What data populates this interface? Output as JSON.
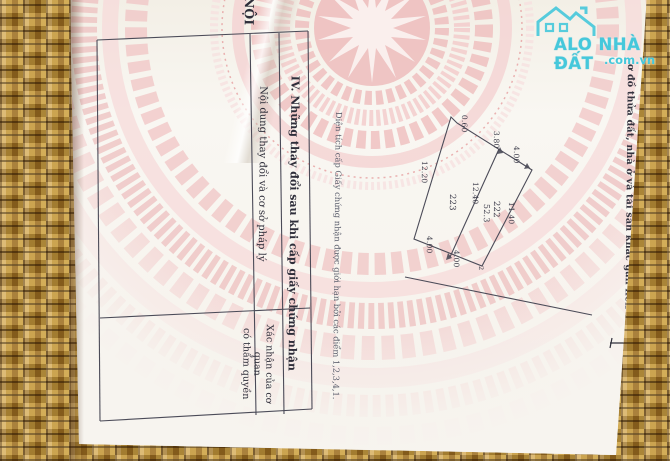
{
  "colors": {
    "accent_cyan": "#45c8db",
    "paper": "#f7f4ef",
    "emblem_pink": "#f0c2c2",
    "mat_tan": "#a3742b",
    "line": "#4b4b58"
  },
  "watermark": {
    "brand": "ALO NHÀ ĐẤT",
    "domain": ".com.vn",
    "icon": "house-icon"
  },
  "document": {
    "corner_text": "NỘI",
    "section3_heading": "ơ đồ thửa đất, nhà ở và tài sản khác gắn liền với đất",
    "note": "Diện tích cấp Giấy chứng nhận được giới hạn bởi các điểm 1,2,3,4,1.",
    "table4": {
      "title": "IV. Những thay đổi sau khi cấp giấy chứng nhận",
      "col1": "Nội dung thay đổi và cơ sở pháp lý",
      "col2_line1": "Xác nhận của cơ quan",
      "col2_line2": "có thẩm quyền"
    },
    "diagram": {
      "jog": "0.60",
      "top1": "3.80",
      "top2": "4.00",
      "left": "12.20",
      "divider": "12.40",
      "right": "11.40",
      "parcel_left": "223",
      "parcel_right": "222",
      "area_right": "52.3",
      "bottom1": "4.00",
      "bottom2": "4.00",
      "point2": "2"
    }
  }
}
